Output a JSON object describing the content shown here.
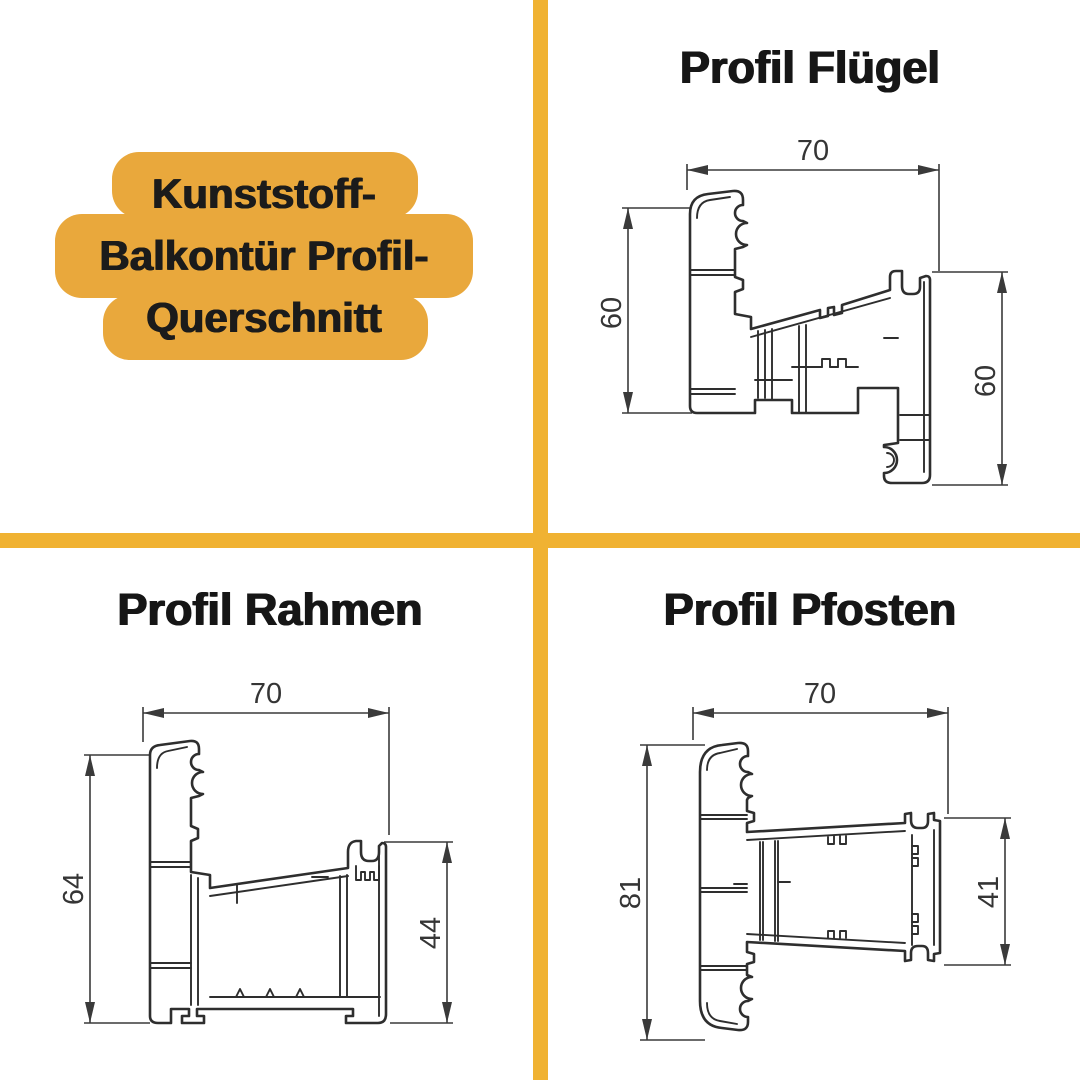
{
  "colors": {
    "badge_yellow": "#E9A83C",
    "divider_yellow": "#F0B232",
    "ink": "#1B1B1B",
    "line_color": "#2E2E2E"
  },
  "badge": {
    "lines": [
      "Kunststoff-",
      "Balkontür Profil-",
      "Querschnitt"
    ]
  },
  "sections": {
    "fluegel": {
      "title": "Profil Flügel",
      "width_mm": "70",
      "left_mm": "60",
      "right_mm": "60"
    },
    "rahmen": {
      "title": "Profil Rahmen",
      "width_mm": "70",
      "left_mm": "64",
      "right_mm": "44"
    },
    "pfosten": {
      "title": "Profil Pfosten",
      "width_mm": "70",
      "left_mm": "81",
      "right_mm": "41"
    }
  }
}
